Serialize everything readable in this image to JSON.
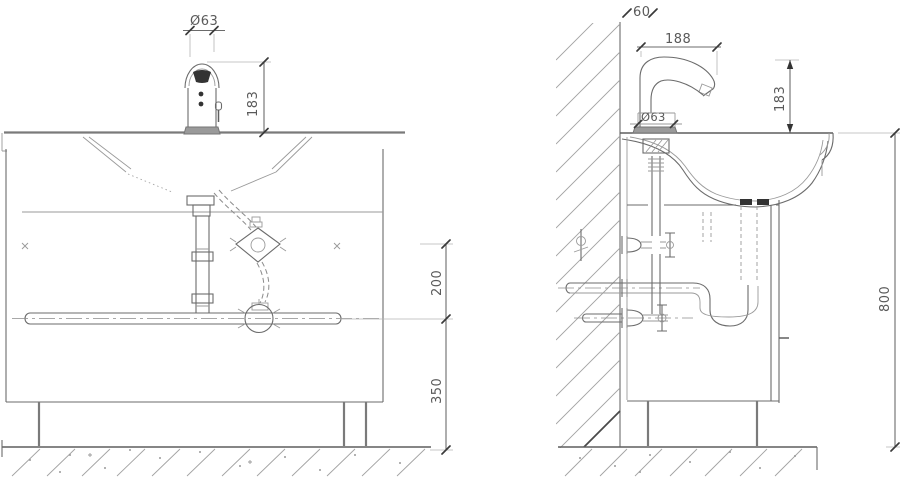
{
  "drawing": {
    "dimensions": {
      "front": {
        "faucet_diameter": "Ø63",
        "faucet_height": "183",
        "supply_offset": "200",
        "supply_height": "350"
      },
      "side": {
        "wall_offset": "60",
        "spout_reach": "188",
        "base_diameter": "Ø63",
        "faucet_height": "183",
        "rim_height": "800"
      }
    }
  }
}
